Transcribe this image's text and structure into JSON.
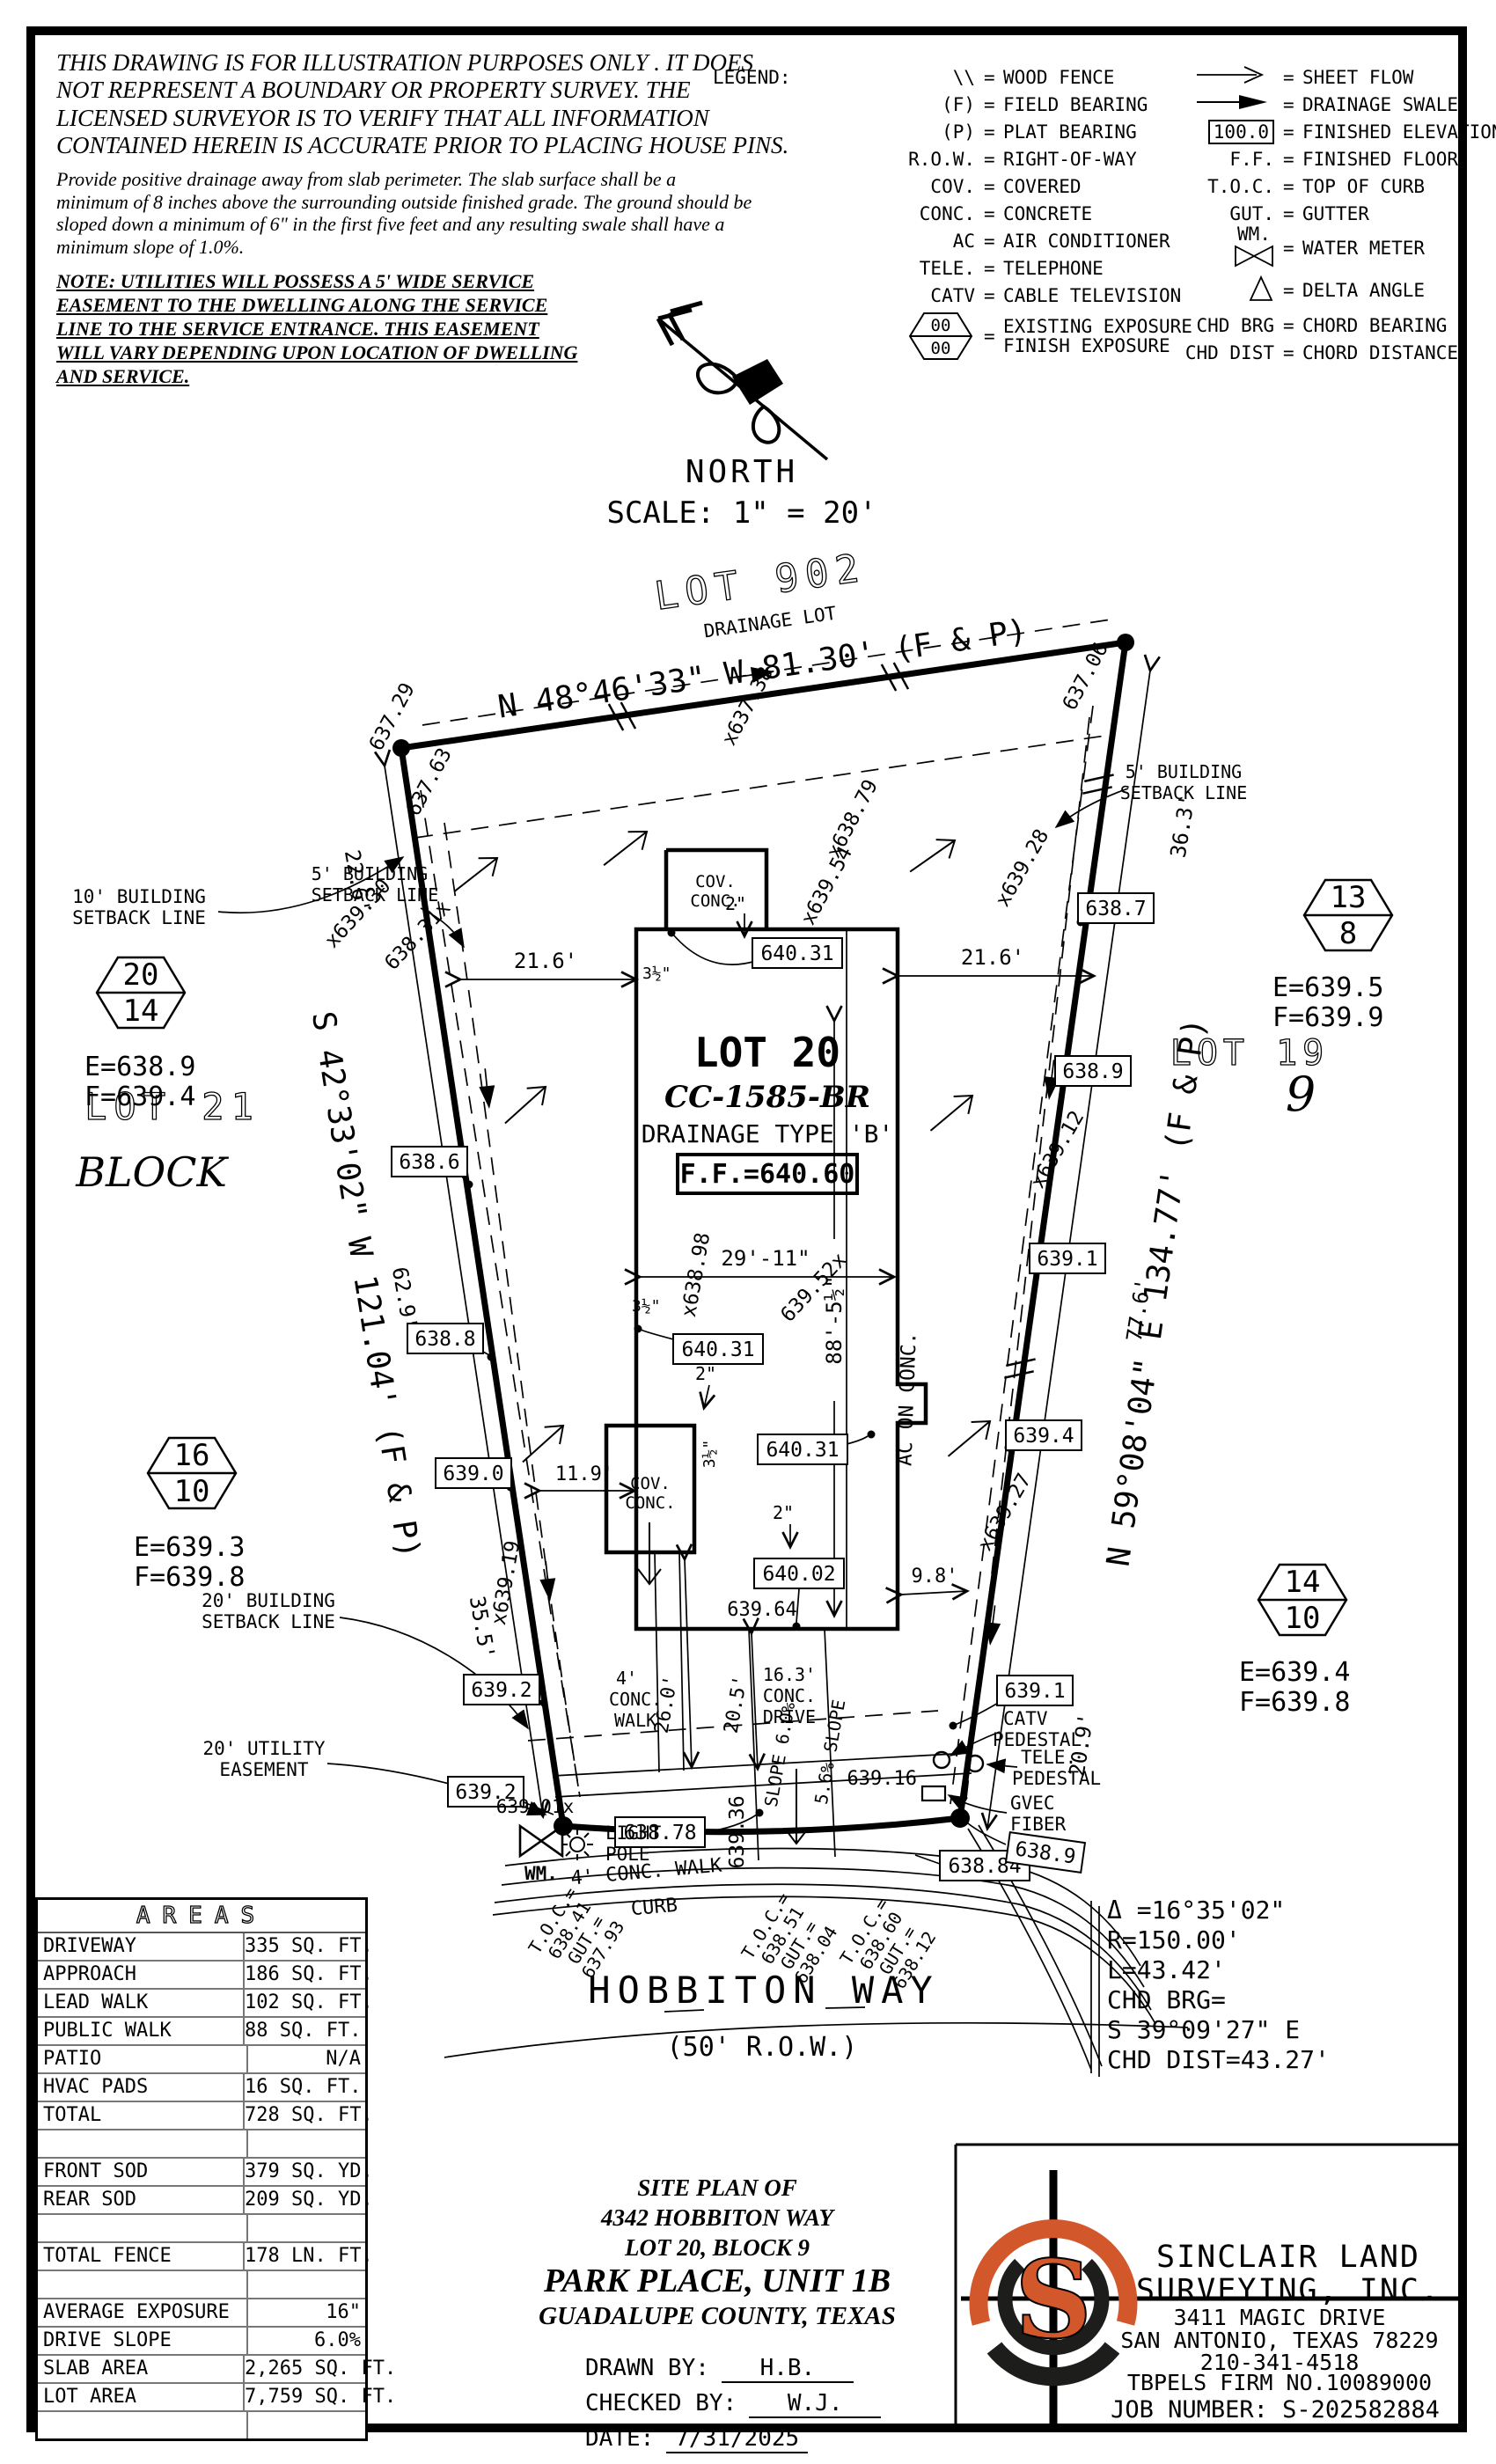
{
  "disclaimer": {
    "para1": [
      "THIS DRAWING IS FOR ILLUSTRATION PURPOSES ONLY . IT DOES",
      "NOT REPRESENT A BOUNDARY OR PROPERTY SURVEY. THE",
      "LICENSED SURVEYOR IS TO VERIFY THAT ALL INFORMATION",
      "CONTAINED HEREIN IS ACCURATE PRIOR TO PLACING HOUSE PINS."
    ],
    "para2": [
      "Provide positive drainage away from slab perimeter. The slab surface shall be a",
      "minimum of 8 inches above the surrounding outside finished grade. The ground should be",
      "sloped down a minimum of 6\" in the first five feet and any resulting swale shall have a",
      "minimum slope of 1.0%."
    ],
    "note": [
      "NOTE: UTILITIES WILL POSSESS A 5' WIDE SERVICE",
      "EASEMENT TO THE DWELLING ALONG THE SERVICE",
      "LINE TO THE SERVICE ENTRANCE. THIS EASEMENT",
      "WILL VARY DEPENDING UPON LOCATION OF DWELLING",
      "AND SERVICE."
    ]
  },
  "legend": {
    "title": "LEGEND:",
    "left": [
      {
        "sym": "\\\\",
        "label": "WOOD FENCE"
      },
      {
        "sym": "(F)",
        "label": "FIELD BEARING"
      },
      {
        "sym": "(P)",
        "label": "PLAT BEARING"
      },
      {
        "sym": "R.O.W.",
        "label": "RIGHT-OF-WAY"
      },
      {
        "sym": "COV.",
        "label": "COVERED"
      },
      {
        "sym": "CONC.",
        "label": "CONCRETE"
      },
      {
        "sym": "AC",
        "label": "AIR CONDITIONER"
      },
      {
        "sym": "TELE.",
        "label": "TELEPHONE"
      },
      {
        "sym": "CATV",
        "label": "CABLE TELEVISION"
      }
    ],
    "hex_top": "00",
    "hex_bottom": "00",
    "hex_label_top": "EXISTING EXPOSURE",
    "hex_label_bottom": "FINISH EXPOSURE",
    "right": [
      {
        "sym": "sheet-flow-arrow",
        "label": "SHEET FLOW"
      },
      {
        "sym": "drainage-swale-arrow",
        "label": "DRAINAGE SWALE"
      },
      {
        "sym": "100.0",
        "label": "FINISHED ELEVATION"
      },
      {
        "sym": "F.F.",
        "label": "FINISHED FLOOR"
      },
      {
        "sym": "T.O.C.",
        "label": "TOP OF CURB"
      },
      {
        "sym": "GUT.",
        "label": "GUTTER"
      },
      {
        "sym": "WM.",
        "label": "WATER METER"
      },
      {
        "sym": "delta-icon",
        "label": "DELTA ANGLE"
      },
      {
        "sym": "CHD BRG",
        "label": "CHORD BEARING"
      },
      {
        "sym": "CHD DIST",
        "label": "CHORD DISTANCE"
      }
    ]
  },
  "north": {
    "label": "NORTH",
    "scale": "SCALE: 1\" = 20'"
  },
  "plan": {
    "lot902": "LOT 902",
    "lot902s": "DRAINAGE LOT",
    "b_top": "N 48°46'33\" W 81.30' (F & P)",
    "b_left": "S 42°33'02\" W 121.04' (F & P)",
    "b_right": "N 59°08'04\" E 134.77' (F & P)",
    "l20a": "LOT 20",
    "l20b": "CC-1585-BR",
    "l20c": "DRAINAGE TYPE 'B'",
    "l20d": "F.F.=640.60",
    "lot21": "LOT 21",
    "blk21": "BLOCK",
    "lot19": "LOT 19",
    "blk19": "9",
    "sb10": [
      "10' BUILDING",
      "SETBACK LINE"
    ],
    "sb5l": [
      "5' BUILDING",
      "SETBACK LINE"
    ],
    "sb5r": [
      "5' BUILDING",
      "SETBACK LINE"
    ],
    "sb20": [
      "20' BUILDING",
      "SETBACK LINE"
    ],
    "ut20": [
      "20' UTILITY",
      "EASEMENT"
    ],
    "covc": [
      "COV.",
      "CONC."
    ],
    "aconc": "AC ON CONC.",
    "drv": [
      "16.3'",
      "CONC.",
      "DRIVE"
    ],
    "walkU": [
      "4'",
      "CONC.",
      "WALK"
    ],
    "walkL": "4' CONC. WALK",
    "curb": "CURB",
    "lp": [
      "LIGHT",
      "POLE"
    ],
    "wm": "WM.",
    "catv": [
      "CATV",
      "PEDESTAL"
    ],
    "tele": [
      "TELE.",
      "PEDESTAL"
    ],
    "gvec": [
      "GVEC",
      "FIBER"
    ],
    "slp1": "SLOPE 6.0%",
    "slp2": "5.6% SLOPE",
    "dims": {
      "d216l": "21.6'",
      "d216r": "21.6'",
      "d226": "22.6'",
      "d629": "62.9'",
      "d355": "35.5'",
      "d363": "36.3'",
      "d776": "77.6'",
      "d209": "20.9'",
      "d2911": "29'-11\"",
      "d885": "88'-5½\"",
      "d119": "11.9'",
      "d98": "9.8'",
      "d260": "26.0'",
      "d205": "20.5'",
      "d2a": "2\"",
      "d2b": "2\"",
      "d2c": "2\"",
      "d35a": "3½\"",
      "d35b": "3½\"",
      "d35c": "3½\""
    },
    "hex": [
      {
        "t": "20",
        "b": "14",
        "e": "E=638.9",
        "f": "F=639.4"
      },
      {
        "t": "16",
        "b": "10",
        "e": "E=639.3",
        "f": "F=639.8"
      },
      {
        "t": "13",
        "b": "8",
        "e": "E=639.5",
        "f": "F=639.9"
      },
      {
        "t": "14",
        "b": "10",
        "e": "E=639.4",
        "f": "F=639.8"
      }
    ],
    "box": {
      "b1": "638.6",
      "b2": "638.8",
      "b3": "639.0",
      "b4": "639.2",
      "b5": "639.2",
      "b6": "638.7",
      "b7": "638.9",
      "b8": "639.1",
      "b9": "639.4",
      "b10": "639.1",
      "b11": "640.31",
      "b12": "640.31",
      "b13": "640.31",
      "b14": "640.02",
      "b15": "638.78",
      "b16": "638.84",
      "b17": "638.9"
    },
    "spot": {
      "s1": "637.29",
      "s2": "637.63",
      "s3": "x637.38",
      "s4": "637.06",
      "s5": "x638.79",
      "s6": "x639.54",
      "s7": "x639.30",
      "s8": "638.31x",
      "s9": "x639.28",
      "s10": "x639.12",
      "s11": "x639.27",
      "s12": "x638.98",
      "s13": "639.52x",
      "s14": "x639.19",
      "s15": "639.36",
      "s16": "639.16",
      "s17": "639.01x",
      "s18": "639.64"
    },
    "toc1": [
      "T.O.C.=",
      "638.41",
      "GUT.=",
      "637.93"
    ],
    "toc2": [
      "T.O.C.=",
      "638.51",
      "GUT.=",
      "638.04"
    ],
    "toc3": [
      "T.O.C.=",
      "638.60",
      "GUT.=",
      "638.12"
    ],
    "curve": [
      "Δ =16°35'02\"",
      "R=150.00'",
      "L=43.42'",
      "CHD BRG=",
      "S 39°09'27\" E",
      "CHD DIST=43.27'"
    ],
    "st1": "HOBBITON WAY",
    "st2": "(50' R.O.W.)"
  },
  "areas": {
    "title": "AREAS",
    "rows": [
      {
        "label": "DRIVEWAY",
        "value": "335 SQ. FT."
      },
      {
        "label": "APPROACH",
        "value": "186 SQ. FT."
      },
      {
        "label": "LEAD WALK",
        "value": "102 SQ. FT."
      },
      {
        "label": "PUBLIC WALK",
        "value": "88 SQ. FT."
      },
      {
        "label": "PATIO",
        "value": "N/A"
      },
      {
        "label": "HVAC PADS",
        "value": "16 SQ. FT."
      },
      {
        "label": "TOTAL",
        "value": "728 SQ. FT."
      },
      {
        "label": "",
        "value": ""
      },
      {
        "label": "FRONT SOD",
        "value": "379 SQ. YD."
      },
      {
        "label": "REAR SOD",
        "value": "209 SQ. YD."
      },
      {
        "label": "",
        "value": ""
      },
      {
        "label": "TOTAL FENCE",
        "value": "178 LN. FT."
      },
      {
        "label": "",
        "value": ""
      },
      {
        "label": "AVERAGE EXPOSURE",
        "value": "16\""
      },
      {
        "label": "DRIVE SLOPE",
        "value": "6.0%"
      },
      {
        "label": "SLAB AREA",
        "value": "2,265 SQ. FT."
      },
      {
        "label": "LOT AREA",
        "value": "7,759 SQ. FT."
      },
      {
        "label": "",
        "value": ""
      }
    ]
  },
  "titleblock": {
    "l1": "SITE PLAN OF",
    "l2": "4342 HOBBITON WAY",
    "l3": "LOT 20, BLOCK 9",
    "l4": "PARK PLACE, UNIT 1B",
    "l5": "GUADALUPE COUNTY, TEXAS",
    "drawn_label": "DRAWN BY:",
    "drawn": "H.B.",
    "checked_label": "CHECKED BY:",
    "checked": "W.J.",
    "date_label": "DATE:",
    "date": "7/31/2025"
  },
  "firm": {
    "logo_s": "S",
    "accent": "#D2572B",
    "name1": "SINCLAIR LAND",
    "name2": "SURVEYING, INC.",
    "addr1": "3411 MAGIC DRIVE",
    "addr2": "SAN ANTONIO, TEXAS 78229",
    "phone": "210-341-4518",
    "tbpels": "TBPELS FIRM NO.10089000",
    "job": "JOB NUMBER: S-202582884"
  }
}
